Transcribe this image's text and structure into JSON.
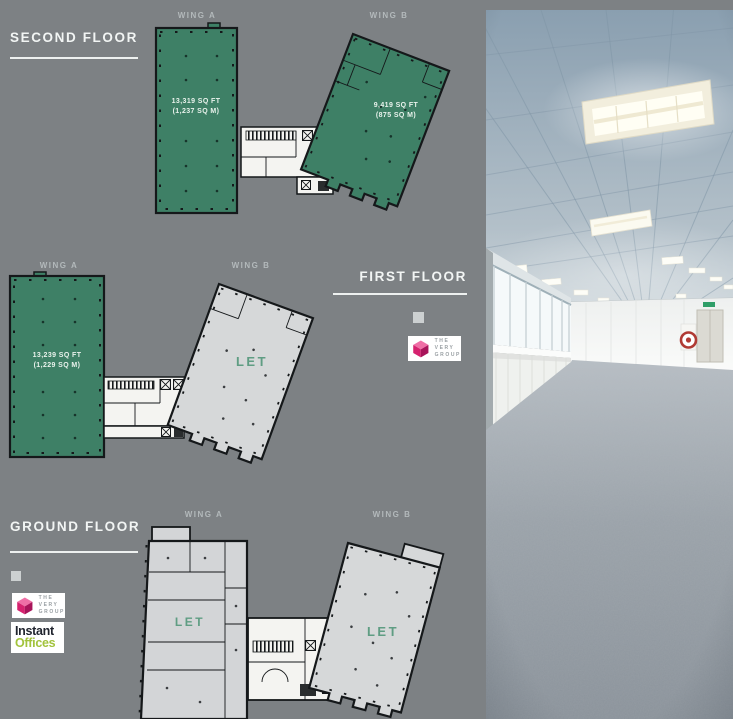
{
  "panel": {
    "floors": {
      "second": {
        "title": "SECOND FLOOR",
        "wing_a": {
          "label": "WING A",
          "area_ft": "13,319 SQ FT",
          "area_m": "(1,237 SQ M)"
        },
        "wing_b": {
          "label": "WING B",
          "area_ft": "9,419 SQ FT",
          "area_m": "(875 SQ M)"
        }
      },
      "first": {
        "title": "FIRST FLOOR",
        "wing_a": {
          "label": "WING A",
          "area_ft": "13,239 SQ FT",
          "area_m": "(1,229 SQ M)"
        },
        "wing_b": {
          "label": "WING B",
          "status": "LET"
        }
      },
      "ground": {
        "title": "GROUND FLOOR",
        "wing_a": {
          "label": "WING A",
          "status": "LET"
        },
        "wing_b": {
          "label": "WING B",
          "status": "LET"
        }
      }
    },
    "logos": {
      "very_group": {
        "line1": "THE",
        "line2": "VERY",
        "line3": "GROUP"
      },
      "instant_offices": {
        "word1": "Instant",
        "word2": "Offices"
      }
    }
  },
  "colors": {
    "background_gray": "#7d8184",
    "available_green": "#3e8066",
    "let_fill_gray": "#d6d8d9",
    "let_text_green": "#5f9d83",
    "heading_white": "#f2f5f4",
    "plan_outline": "#15181a",
    "very_group_pink": "#d6226f",
    "instant_offices_green": "#a2c33c"
  }
}
